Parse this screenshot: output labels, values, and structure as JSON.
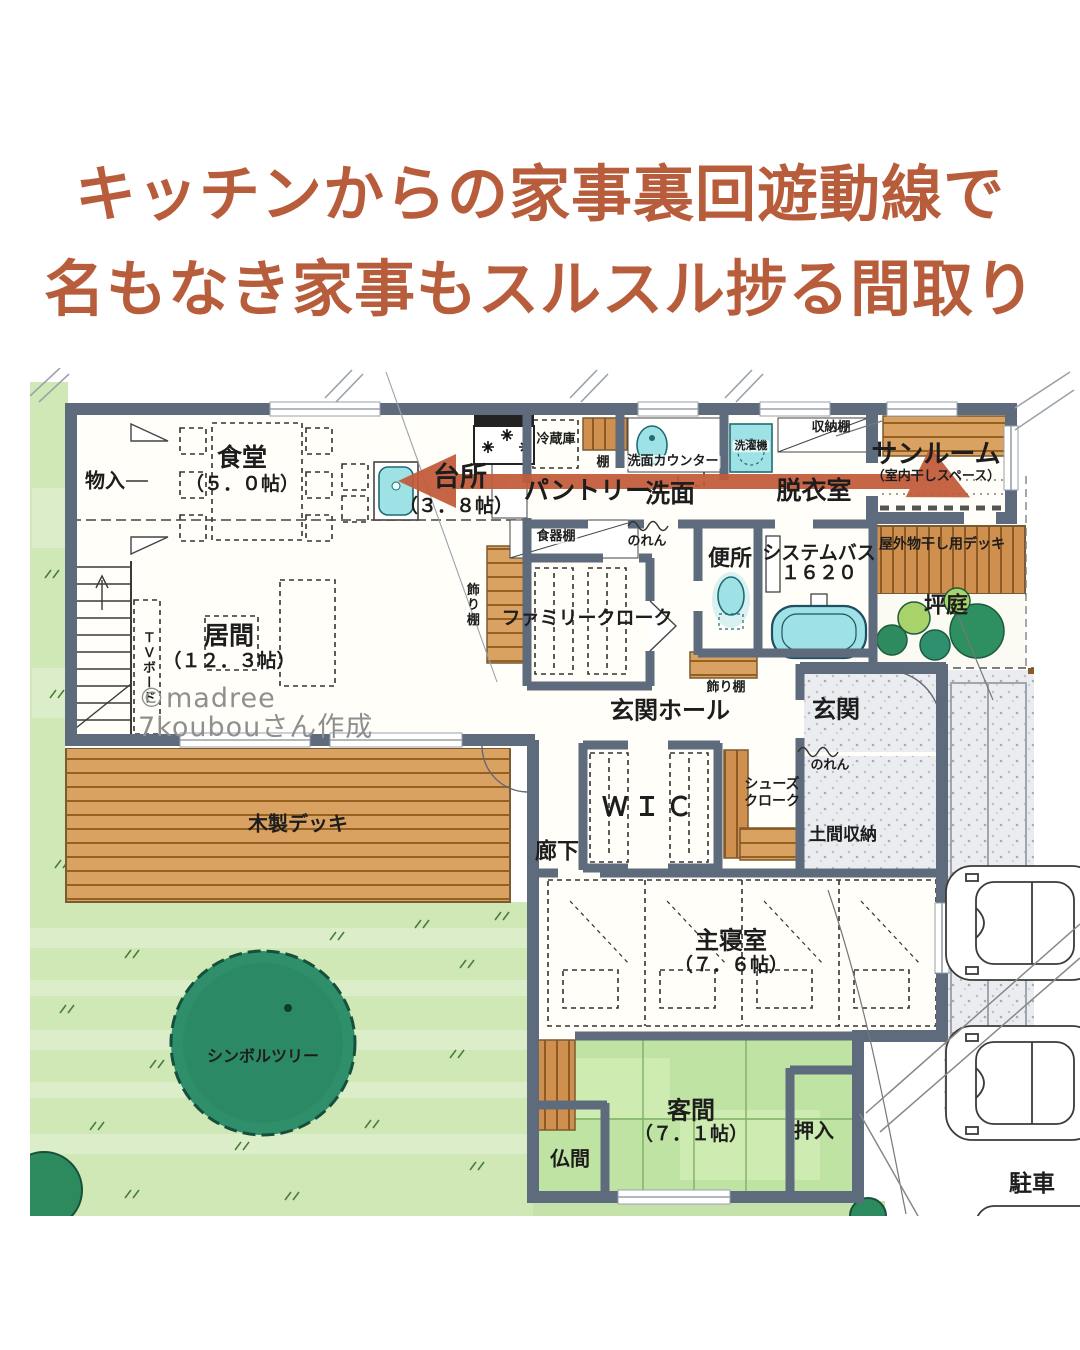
{
  "title": {
    "line1": "キッチンからの家事裏回遊動線で",
    "line2": "名もなき家事もスルスル捗る間取り"
  },
  "watermark": {
    "line1": "©madree",
    "line2": "7koubouさん作成"
  },
  "colors": {
    "title_text": "#b85d3b",
    "circulation_arrow": "#c25a38",
    "wall": "#5d6b7c",
    "lawn": "#cfe8b5",
    "symbol_tree": "#2f8f6b",
    "wood_deck": "#d9a262",
    "tatami": "#bfe3a3",
    "water_fixture": "#9fe2e6",
    "stone_floor": "#eaecef"
  },
  "icons": {
    "circulation-arrow": "double-headed-arrow",
    "stove-burner-icon": "asterisk-star",
    "up-arrow-icon": "stair-up-arrow"
  },
  "plan": {
    "labels": [
      {
        "text": "物入"
      },
      {
        "text": "食堂"
      },
      {
        "text": "（５．０帖）"
      },
      {
        "text": "台所"
      },
      {
        "text": "（３．８帖）"
      },
      {
        "text": "冷蔵庫"
      },
      {
        "text": "棚"
      },
      {
        "text": "パントリー"
      },
      {
        "text": "洗面カウンター"
      },
      {
        "text": "洗面"
      },
      {
        "text": "洗濯機"
      },
      {
        "text": "収納棚"
      },
      {
        "text": "脱衣室"
      },
      {
        "text": "サンルーム"
      },
      {
        "text": "（室内干しスペース）"
      },
      {
        "text": "食器棚"
      },
      {
        "text": "のれん"
      },
      {
        "text": "便所"
      },
      {
        "text": "システムバス"
      },
      {
        "text": "１６２０"
      },
      {
        "text": "屋外物干し用デッキ"
      },
      {
        "text": "坪庭"
      },
      {
        "text": "飾り棚"
      },
      {
        "text": "ファミリークローク"
      },
      {
        "text": "飾り棚"
      },
      {
        "text": "玄関ホール"
      },
      {
        "text": "玄関"
      },
      {
        "text": "のれん"
      },
      {
        "text": "ＷＩＣ"
      },
      {
        "text": "シューズ"
      },
      {
        "text": "クローク"
      },
      {
        "text": "土間収納"
      },
      {
        "text": "廊下"
      },
      {
        "text": "ＴＶボード"
      },
      {
        "text": "居間"
      },
      {
        "text": "（１２．３帖）"
      },
      {
        "text": "木製デッキ"
      },
      {
        "text": "主寝室"
      },
      {
        "text": "（７．６帖）"
      },
      {
        "text": "客間"
      },
      {
        "text": "（７．１帖）"
      },
      {
        "text": "仏間"
      },
      {
        "text": "押入"
      },
      {
        "text": "シンボルツリー"
      },
      {
        "text": "駐車"
      }
    ]
  }
}
